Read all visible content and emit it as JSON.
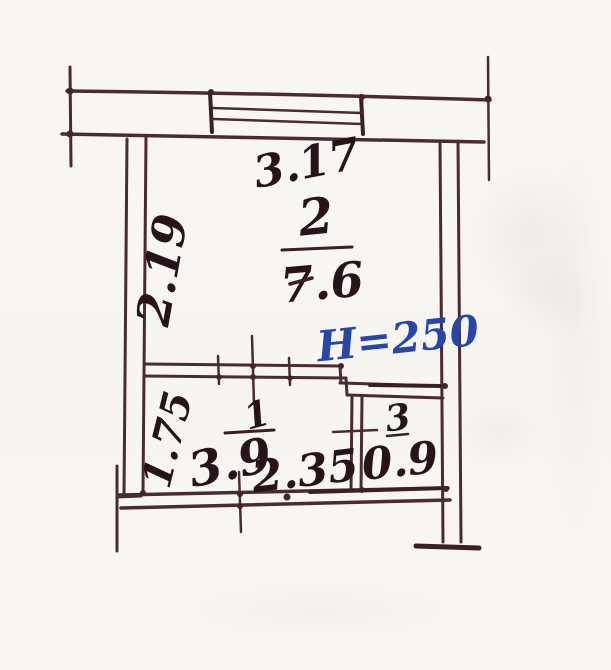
{
  "floor_plan": {
    "rooms": [
      {
        "number": "1",
        "area": "3.9"
      },
      {
        "number": "2",
        "area": "7.6"
      },
      {
        "number": "3",
        "area": "0.9"
      }
    ],
    "dimensions": {
      "top_width": "3.17",
      "left_upper_height": "2.19",
      "left_lower_height": "1.75",
      "bottom_inner_width": "2.35"
    },
    "ceiling_height_note": "H=250",
    "colors": {
      "ink": "#4a2b31",
      "label_ink": "#27141a",
      "blue_ink": "#2746a6",
      "paper": "#f7f5f1"
    }
  }
}
